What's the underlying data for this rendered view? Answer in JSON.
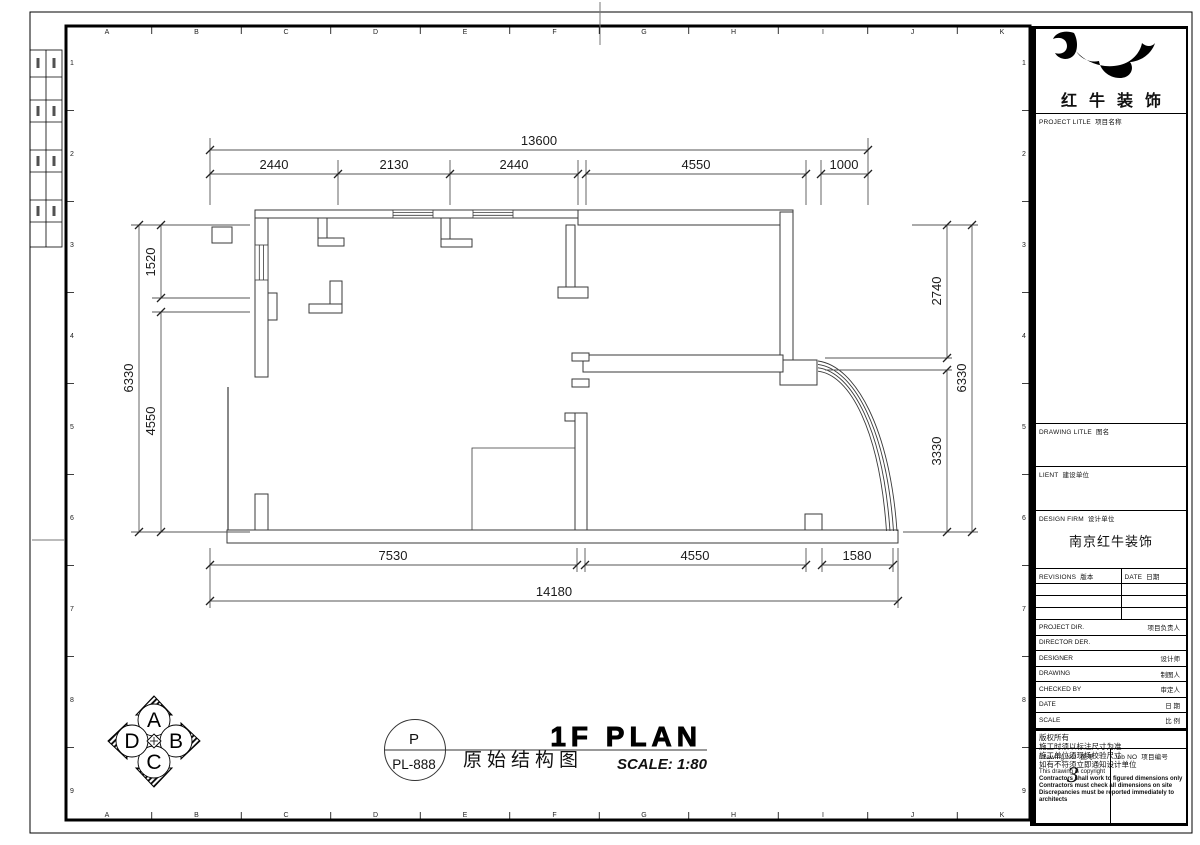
{
  "sheet": {
    "cols": [
      "A",
      "B",
      "C",
      "D",
      "E",
      "F",
      "G",
      "H",
      "I",
      "J",
      "K"
    ],
    "rows": [
      "1",
      "2",
      "3",
      "4",
      "5",
      "6",
      "7",
      "8",
      "9"
    ]
  },
  "plan": {
    "title_en": "1F PLAN",
    "title_cn": "原始结构图",
    "scale": "SCALE: 1:80",
    "ref": {
      "code": "P",
      "number": "PL-888"
    },
    "compass": {
      "top": "A",
      "right": "B",
      "bottom": "C",
      "left": "D"
    },
    "dims": {
      "top_total": "13600",
      "top_segments": [
        "2440",
        "2130",
        "2440",
        "4550",
        "1000"
      ],
      "left_total": "6330",
      "left_segments": [
        "1520",
        "4550"
      ],
      "right_total": "6330",
      "right_segments": [
        "2740",
        "3330"
      ],
      "bottom_total": "14180",
      "bottom_segments": [
        "7530",
        "4550",
        "1580"
      ]
    }
  },
  "title_block": {
    "company": "红牛装饰",
    "project": {
      "en": "PROJECT LITLE",
      "cn": "项目名称"
    },
    "drawing_title": {
      "en": "DRAWING LITLE",
      "cn": "图名"
    },
    "client": {
      "en": "LIENT",
      "cn": "建设单位"
    },
    "design_firm": {
      "en": "DESIGN FIRM",
      "cn": "设计单位",
      "value": "南京红牛装饰"
    },
    "revisions": {
      "en": "REVISIONS",
      "cn": "版本"
    },
    "date_col": {
      "en": "DATE",
      "cn": "日期"
    },
    "info_rows": [
      {
        "en": "PROJECT DIR.",
        "cn": "项目负责人"
      },
      {
        "en": "DIRECTOR DER.",
        "cn": ""
      },
      {
        "en": "DESIGNER",
        "cn": "设计师"
      },
      {
        "en": "DRAWING",
        "cn": "制图人"
      },
      {
        "en": "CHECKED BY",
        "cn": "审定人"
      },
      {
        "en": "DATE",
        "cn": "日 期"
      },
      {
        "en": "SCALE",
        "cn": "比 例"
      }
    ],
    "notes": [
      "版权所有",
      "施工时须以标注尺寸为准",
      "施工单位须现场校验尺寸",
      "如有不符须立即通知设计单位",
      "This drawing is copyright",
      "Contractors shall work to figured dimensions only",
      "Contractors must check all dimensions on site",
      "Discrepancies must be reported immediately to architects"
    ],
    "drawing_no": {
      "en": "Drawing NO",
      "cn": "图号",
      "value": "3"
    },
    "job_no": {
      "en": "Job NO",
      "cn": "项目编号",
      "value": ""
    }
  }
}
